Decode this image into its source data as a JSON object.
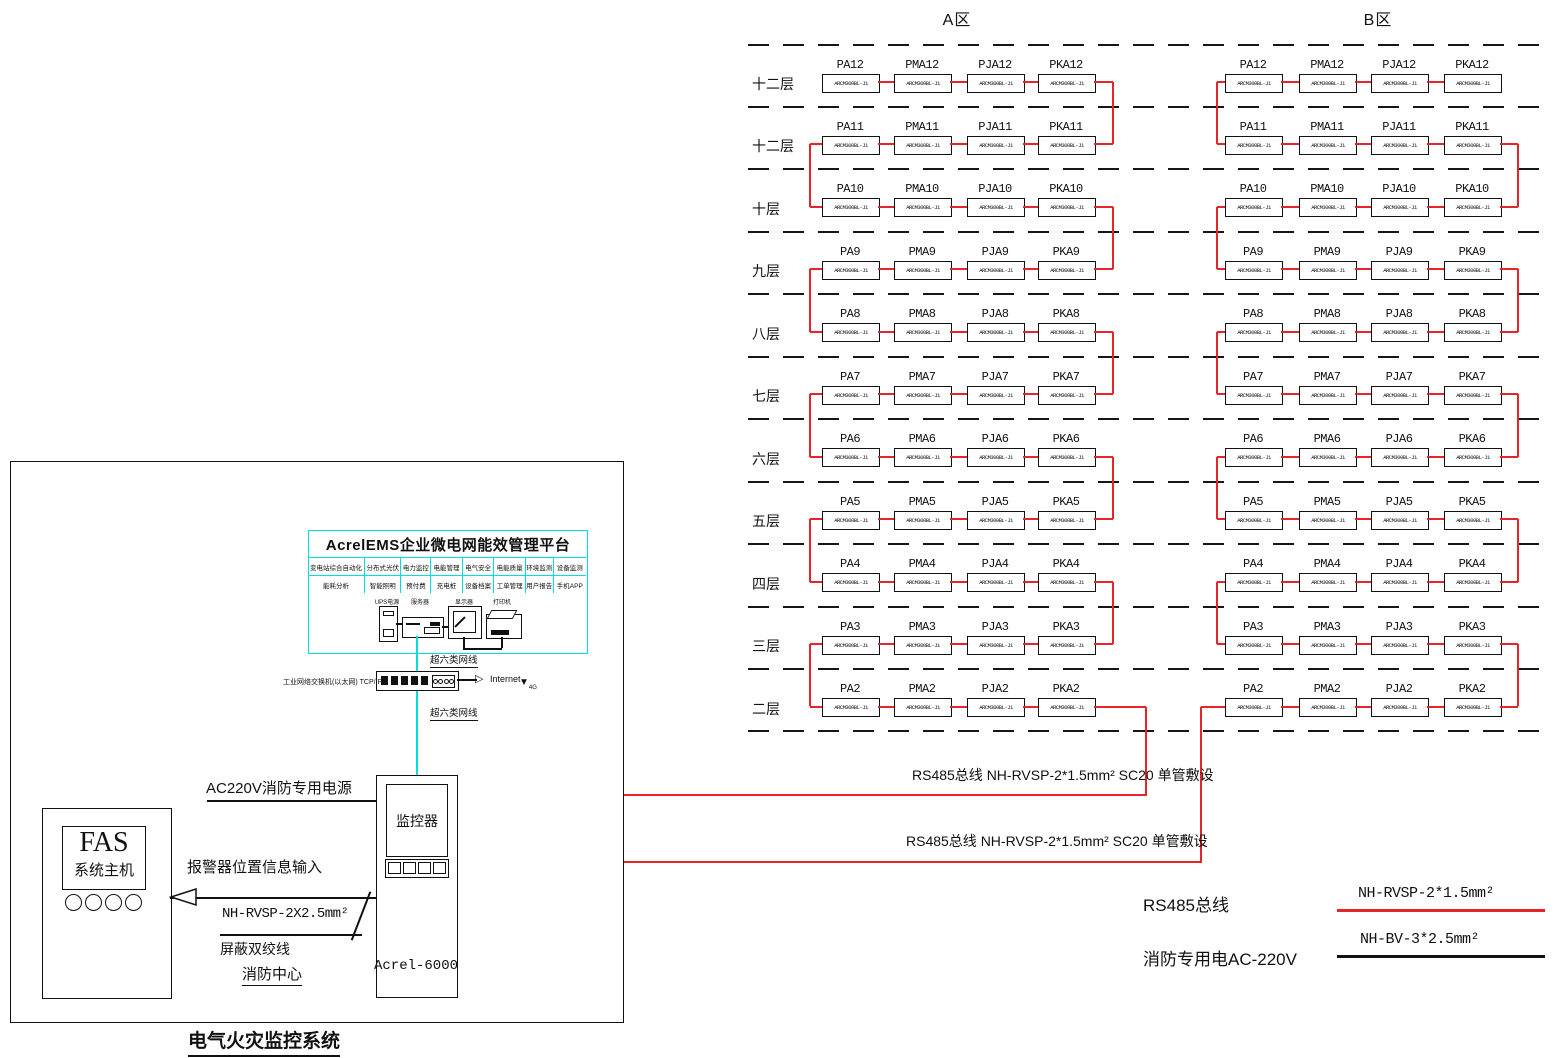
{
  "zones": {
    "a": {
      "title": "A区"
    },
    "b": {
      "title": "B区"
    }
  },
  "floors": [
    {
      "label": "十二层",
      "num": 12
    },
    {
      "label": "十二层",
      "num": 11
    },
    {
      "label": "十层",
      "num": 10
    },
    {
      "label": "九层",
      "num": 9
    },
    {
      "label": "八层",
      "num": 8
    },
    {
      "label": "七层",
      "num": 7
    },
    {
      "label": "六层",
      "num": 6
    },
    {
      "label": "五层",
      "num": 5
    },
    {
      "label": "四层",
      "num": 4
    },
    {
      "label": "三层",
      "num": 3
    },
    {
      "label": "二层",
      "num": 2
    }
  ],
  "device_prefixes": [
    "PA",
    "PMA",
    "PJA",
    "PKA"
  ],
  "device_model": "ARCM300BL-J1",
  "platform": {
    "title": "AcrelEMS企业微电网能效管理平台",
    "features_row1": [
      "变电站综合自动化",
      "分布式光伏",
      "电力监控",
      "电能管理",
      "电气安全",
      "电能质量",
      "环境监测",
      "设备监测"
    ],
    "features_row2": [
      "能耗分析",
      "智能照明",
      "预付费",
      "充电桩",
      "设备档案",
      "工单管理",
      "用户报告",
      "手机APP"
    ],
    "equipment": [
      "UPS电源",
      "服务器",
      "显示器",
      "打印机"
    ]
  },
  "network": {
    "cable_label_top": "超六类网线",
    "cable_label_bottom": "超六类网线",
    "switch_label": "工业网络交换机(以太网) TCP/IP",
    "internet_label": "Internet",
    "wireless_label": "4G"
  },
  "cabinet": {
    "screen_label": "监控器",
    "model": "Acrel-6000"
  },
  "fas": {
    "title": "FAS",
    "subtitle": "系统主机"
  },
  "connections": {
    "power_label": "AC220V消防专用电源",
    "alarm_label": "报警器位置信息输入",
    "cable_spec": "NH-RVSP-2X2.5mm²",
    "shielded_pair": "屏蔽双绞线",
    "fire_center": "消防中心"
  },
  "system_title": "电气火灾监控系统",
  "bus_labels": {
    "bus1": "RS485总线 NH-RVSP-2*1.5mm² SC20 单管敷设",
    "bus2": "RS485总线 NH-RVSP-2*1.5mm² SC20 单管敷设"
  },
  "legend": {
    "rs485": "RS485总线",
    "power": "消防专用电AC-220V",
    "red_cable": "NH-RVSP-2*1.5mm²",
    "black_cable": "NH-BV-3*2.5mm²"
  },
  "colors": {
    "bus_red": "#e52527",
    "network_cyan": "#00dfdf"
  }
}
